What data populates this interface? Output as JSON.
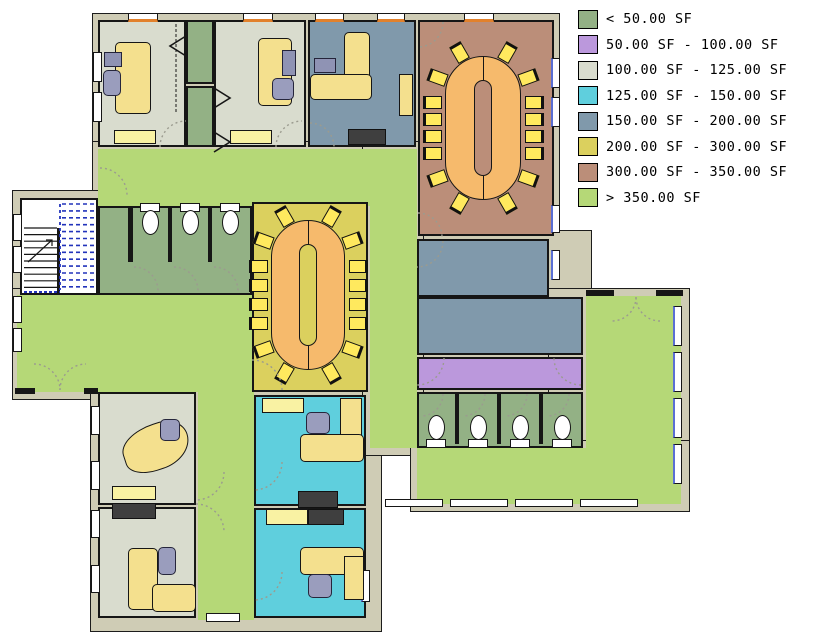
{
  "legend": {
    "items": [
      {
        "label": "< 50.00 SF",
        "color": "#93b185"
      },
      {
        "label": "50.00 SF - 100.00 SF",
        "color": "#bb98dc"
      },
      {
        "label": "100.00 SF - 125.00 SF",
        "color": "#d9dcce"
      },
      {
        "label": "125.00 SF - 150.00 SF",
        "color": "#5fcfdd"
      },
      {
        "label": "150.00 SF - 200.00 SF",
        "color": "#8099ab"
      },
      {
        "label": "200.00 SF - 300.00 SF",
        "color": "#dbd05e"
      },
      {
        "label": "300.00 SF - 350.00 SF",
        "color": "#bb8e79"
      },
      {
        "label": "> 350.00 SF",
        "color": "#b5d877"
      }
    ]
  },
  "plan": {
    "colors": {
      "wall": "#cfccb5",
      "outline": "#1c1c1c",
      "stair_room": "#ffffff",
      "table": "#f6ba6c",
      "chair_yellow": "#ffe95e",
      "door_arc": "#9b9b8f",
      "stair_path": "#2233bb",
      "accent_top": "#e2812c",
      "accent_side": "#5a6fd4"
    },
    "backdrops": [
      {
        "x": 92,
        "y": 13,
        "w": 468,
        "h": 231
      },
      {
        "x": 92,
        "y": 141,
        "w": 290,
        "h": 261
      },
      {
        "x": 12,
        "y": 190,
        "w": 110,
        "h": 210
      },
      {
        "x": 12,
        "y": 288,
        "w": 248,
        "h": 112
      },
      {
        "x": 90,
        "y": 384,
        "w": 292,
        "h": 248
      },
      {
        "x": 410,
        "y": 230,
        "w": 182,
        "h": 282
      },
      {
        "x": 548,
        "y": 288,
        "w": 142,
        "h": 224
      },
      {
        "x": 362,
        "y": 141,
        "w": 62,
        "h": 315
      },
      {
        "x": 410,
        "y": 440,
        "w": 280,
        "h": 72
      }
    ],
    "halls": [
      {
        "name": "corridor-north",
        "x": 98,
        "y": 149,
        "w": 318,
        "h": 57
      },
      {
        "name": "corridor-mid-vertical",
        "x": 370,
        "y": 149,
        "w": 47,
        "h": 299
      },
      {
        "name": "lobby-west",
        "x": 17,
        "y": 295,
        "w": 235,
        "h": 97
      },
      {
        "name": "corridor-south",
        "x": 198,
        "y": 392,
        "w": 56,
        "h": 228
      },
      {
        "name": "hall-southeast",
        "x": 417,
        "y": 448,
        "w": 264,
        "h": 56
      },
      {
        "name": "open-room-east",
        "x": 586,
        "y": 296,
        "w": 95,
        "h": 208
      }
    ],
    "rooms": [
      {
        "name": "office-nw-1",
        "cat": 2,
        "x": 98,
        "y": 20,
        "w": 88,
        "h": 127
      },
      {
        "name": "closet-nw-a",
        "cat": 0,
        "x": 186,
        "y": 20,
        "w": 28,
        "h": 64
      },
      {
        "name": "closet-nw-b",
        "cat": 0,
        "x": 186,
        "y": 86,
        "w": 28,
        "h": 61
      },
      {
        "name": "office-nw-2",
        "cat": 2,
        "x": 214,
        "y": 20,
        "w": 92,
        "h": 127
      },
      {
        "name": "office-nw-3",
        "cat": 4,
        "x": 308,
        "y": 20,
        "w": 108,
        "h": 127
      },
      {
        "name": "conference-room-north",
        "cat": 6,
        "x": 418,
        "y": 20,
        "w": 136,
        "h": 216
      },
      {
        "name": "restroom-west",
        "cat": 0,
        "x": 98,
        "y": 206,
        "w": 154,
        "h": 89
      },
      {
        "name": "conference-room-center",
        "cat": 5,
        "x": 252,
        "y": 202,
        "w": 116,
        "h": 190
      },
      {
        "name": "office-sw-1",
        "cat": 2,
        "x": 98,
        "y": 392,
        "w": 98,
        "h": 113
      },
      {
        "name": "office-sw-2",
        "cat": 2,
        "x": 98,
        "y": 507,
        "w": 98,
        "h": 111
      },
      {
        "name": "office-s-1",
        "cat": 3,
        "x": 254,
        "y": 395,
        "w": 112,
        "h": 111
      },
      {
        "name": "office-s-2",
        "cat": 3,
        "x": 254,
        "y": 508,
        "w": 112,
        "h": 110
      },
      {
        "name": "room-east-upper",
        "cat": 4,
        "x": 417,
        "y": 239,
        "w": 132,
        "h": 58
      },
      {
        "name": "room-east-lower",
        "cat": 4,
        "x": 417,
        "y": 297,
        "w": 166,
        "h": 58
      },
      {
        "name": "corridor-east",
        "cat": 1,
        "x": 417,
        "y": 357,
        "w": 166,
        "h": 33
      },
      {
        "name": "restroom-east",
        "cat": 0,
        "x": 417,
        "y": 392,
        "w": 166,
        "h": 56
      }
    ],
    "stairwell": {
      "x": 20,
      "y": 198,
      "w": 78,
      "h": 97
    },
    "wall_segments": [
      {
        "x": 586,
        "y": 290,
        "w": 28,
        "h": 6
      },
      {
        "x": 656,
        "y": 290,
        "w": 27,
        "h": 6
      },
      {
        "x": 15,
        "y": 388,
        "w": 20,
        "h": 6
      },
      {
        "x": 84,
        "y": 388,
        "w": 14,
        "h": 6
      },
      {
        "x": 128,
        "y": 206,
        "w": 5,
        "h": 56
      },
      {
        "x": 168,
        "y": 206,
        "w": 4,
        "h": 56
      },
      {
        "x": 208,
        "y": 206,
        "w": 4,
        "h": 56
      },
      {
        "x": 455,
        "y": 394,
        "w": 4,
        "h": 50
      },
      {
        "x": 497,
        "y": 394,
        "w": 4,
        "h": 50
      },
      {
        "x": 539,
        "y": 394,
        "w": 4,
        "h": 50
      }
    ],
    "windows": [
      {
        "x": 128,
        "y": 13,
        "w": 30,
        "h": 9,
        "a": "t"
      },
      {
        "x": 243,
        "y": 13,
        "w": 30,
        "h": 9,
        "a": "t"
      },
      {
        "x": 315,
        "y": 13,
        "w": 29,
        "h": 9,
        "a": "t"
      },
      {
        "x": 377,
        "y": 13,
        "w": 28,
        "h": 9,
        "a": "t"
      },
      {
        "x": 464,
        "y": 13,
        "w": 30,
        "h": 9,
        "a": "t"
      },
      {
        "x": 551,
        "y": 58,
        "w": 9,
        "h": 30,
        "a": "s"
      },
      {
        "x": 551,
        "y": 97,
        "w": 9,
        "h": 30,
        "a": "s"
      },
      {
        "x": 551,
        "y": 205,
        "w": 9,
        "h": 28,
        "a": "s"
      },
      {
        "x": 551,
        "y": 250,
        "w": 9,
        "h": 30,
        "a": "s"
      },
      {
        "x": 93,
        "y": 52,
        "w": 9,
        "h": 30,
        "a": "n"
      },
      {
        "x": 93,
        "y": 92,
        "w": 9,
        "h": 30,
        "a": "n"
      },
      {
        "x": 13,
        "y": 214,
        "w": 9,
        "h": 27,
        "a": "n"
      },
      {
        "x": 13,
        "y": 246,
        "w": 9,
        "h": 27,
        "a": "n"
      },
      {
        "x": 13,
        "y": 296,
        "w": 9,
        "h": 27,
        "a": "n"
      },
      {
        "x": 13,
        "y": 328,
        "w": 9,
        "h": 24,
        "a": "n"
      },
      {
        "x": 91,
        "y": 406,
        "w": 9,
        "h": 29,
        "a": "n"
      },
      {
        "x": 91,
        "y": 461,
        "w": 9,
        "h": 29,
        "a": "n"
      },
      {
        "x": 91,
        "y": 510,
        "w": 9,
        "h": 28,
        "a": "n"
      },
      {
        "x": 91,
        "y": 565,
        "w": 9,
        "h": 28,
        "a": "n"
      },
      {
        "x": 206,
        "y": 613,
        "w": 34,
        "h": 9,
        "a": "n"
      },
      {
        "x": 361,
        "y": 570,
        "w": 9,
        "h": 32,
        "a": "s"
      },
      {
        "x": 673,
        "y": 306,
        "w": 9,
        "h": 40,
        "a": "s"
      },
      {
        "x": 673,
        "y": 352,
        "w": 9,
        "h": 40,
        "a": "s"
      },
      {
        "x": 673,
        "y": 398,
        "w": 9,
        "h": 40,
        "a": "s"
      },
      {
        "x": 673,
        "y": 444,
        "w": 9,
        "h": 40,
        "a": "s"
      },
      {
        "x": 385,
        "y": 499,
        "w": 58,
        "h": 8,
        "a": "n"
      },
      {
        "x": 450,
        "y": 499,
        "w": 58,
        "h": 8,
        "a": "n"
      },
      {
        "x": 515,
        "y": 499,
        "w": 58,
        "h": 8,
        "a": "n"
      },
      {
        "x": 580,
        "y": 499,
        "w": 58,
        "h": 8,
        "a": "n"
      }
    ],
    "furniture": [
      {
        "t": "desk",
        "x": 115,
        "y": 42,
        "w": 36,
        "h": 72
      },
      {
        "t": "chair",
        "x": 103,
        "y": 70,
        "w": 18,
        "h": 26
      },
      {
        "t": "monitor",
        "x": 104,
        "y": 52,
        "w": 18,
        "h": 15
      },
      {
        "t": "cabinet",
        "x": 114,
        "y": 130,
        "w": 42,
        "h": 14
      },
      {
        "t": "desk",
        "x": 258,
        "y": 38,
        "w": 34,
        "h": 68
      },
      {
        "t": "monitor",
        "x": 282,
        "y": 50,
        "w": 14,
        "h": 26
      },
      {
        "t": "chair",
        "x": 272,
        "y": 78,
        "w": 22,
        "h": 22
      },
      {
        "t": "cabinet",
        "x": 230,
        "y": 130,
        "w": 42,
        "h": 14
      },
      {
        "t": "desk",
        "x": 344,
        "y": 32,
        "w": 26,
        "h": 54
      },
      {
        "t": "desk",
        "x": 310,
        "y": 74,
        "w": 62,
        "h": 26
      },
      {
        "t": "monitor",
        "x": 314,
        "y": 58,
        "w": 22,
        "h": 15
      },
      {
        "t": "panel",
        "x": 399,
        "y": 74,
        "w": 14,
        "h": 42
      },
      {
        "t": "credenza",
        "x": 348,
        "y": 129,
        "w": 38,
        "h": 16
      },
      {
        "t": "blob",
        "x": 122,
        "y": 424,
        "w": 68,
        "h": 46
      },
      {
        "t": "chair",
        "x": 160,
        "y": 419,
        "w": 20,
        "h": 22
      },
      {
        "t": "cabinet",
        "x": 112,
        "y": 486,
        "w": 44,
        "h": 14
      },
      {
        "t": "credenza",
        "x": 112,
        "y": 503,
        "w": 44,
        "h": 16
      },
      {
        "t": "desk",
        "x": 128,
        "y": 548,
        "w": 30,
        "h": 62
      },
      {
        "t": "desk",
        "x": 152,
        "y": 584,
        "w": 44,
        "h": 28
      },
      {
        "t": "chair",
        "x": 158,
        "y": 547,
        "w": 18,
        "h": 28
      },
      {
        "t": "cabinet",
        "x": 262,
        "y": 398,
        "w": 42,
        "h": 15
      },
      {
        "t": "panel",
        "x": 340,
        "y": 398,
        "w": 22,
        "h": 44
      },
      {
        "t": "desk",
        "x": 300,
        "y": 434,
        "w": 64,
        "h": 28
      },
      {
        "t": "chair",
        "x": 306,
        "y": 412,
        "w": 24,
        "h": 22
      },
      {
        "t": "credenza",
        "x": 298,
        "y": 491,
        "w": 40,
        "h": 17
      },
      {
        "t": "cabinet",
        "x": 266,
        "y": 509,
        "w": 42,
        "h": 16
      },
      {
        "t": "credenza",
        "x": 308,
        "y": 509,
        "w": 36,
        "h": 16
      },
      {
        "t": "desk",
        "x": 300,
        "y": 547,
        "w": 64,
        "h": 28
      },
      {
        "t": "chair",
        "x": 308,
        "y": 574,
        "w": 24,
        "h": 24
      },
      {
        "t": "panel",
        "x": 344,
        "y": 556,
        "w": 20,
        "h": 44
      }
    ],
    "tables": [
      {
        "name": "conference-table-north",
        "x": 445,
        "y": 56,
        "w": 76,
        "h": 144,
        "slotFill": "#bb8e79"
      },
      {
        "name": "conference-table-center",
        "x": 271,
        "y": 220,
        "w": 74,
        "h": 150,
        "slotFill": "#dbd05e"
      }
    ],
    "toilets": [
      {
        "cx": 150,
        "cy": 221,
        "d": 1
      },
      {
        "cx": 190,
        "cy": 221,
        "d": 1
      },
      {
        "cx": 230,
        "cy": 221,
        "d": 1
      },
      {
        "cx": 436,
        "cy": 431,
        "d": -1
      },
      {
        "cx": 478,
        "cy": 431,
        "d": -1
      },
      {
        "cx": 520,
        "cy": 431,
        "d": -1
      },
      {
        "cx": 562,
        "cy": 431,
        "d": -1
      }
    ],
    "door_arcs": [
      {
        "cx": 186,
        "cy": 147,
        "r": 26,
        "a0": 180,
        "a1": 270
      },
      {
        "cx": 302,
        "cy": 147,
        "r": 26,
        "a0": 180,
        "a1": 270
      },
      {
        "cx": 310,
        "cy": 147,
        "r": 24,
        "a0": 270,
        "a1": 360
      },
      {
        "cx": 418,
        "cy": 22,
        "r": 25,
        "a0": 0,
        "a1": 90
      },
      {
        "cx": 418,
        "cy": 237,
        "r": 24,
        "a0": 270,
        "a1": 360
      },
      {
        "cx": 417,
        "cy": 241,
        "r": 26,
        "a0": 0,
        "a1": 90
      },
      {
        "cx": 252,
        "cy": 390,
        "r": 30,
        "a0": 270,
        "a1": 360
      },
      {
        "cx": 100,
        "cy": 195,
        "r": 27,
        "a0": 270,
        "a1": 360
      },
      {
        "cx": 34,
        "cy": 390,
        "r": 26,
        "a0": 270,
        "a1": 360
      },
      {
        "cx": 86,
        "cy": 390,
        "r": 26,
        "a0": 180,
        "a1": 270
      },
      {
        "cx": 612,
        "cy": 297,
        "r": 24,
        "a0": 0,
        "a1": 90
      },
      {
        "cx": 660,
        "cy": 297,
        "r": 24,
        "a0": 90,
        "a1": 180
      },
      {
        "cx": 196,
        "cy": 472,
        "r": 28,
        "a0": 0,
        "a1": 90
      },
      {
        "cx": 196,
        "cy": 532,
        "r": 28,
        "a0": 270,
        "a1": 360
      },
      {
        "cx": 254,
        "cy": 462,
        "r": 28,
        "a0": 0,
        "a1": 90
      },
      {
        "cx": 254,
        "cy": 572,
        "r": 28,
        "a0": 0,
        "a1": 90
      },
      {
        "cx": 417,
        "cy": 358,
        "r": 27,
        "a0": 0,
        "a1": 90
      },
      {
        "cx": 581,
        "cy": 358,
        "r": 27,
        "a0": 90,
        "a1": 180
      },
      {
        "cx": 421,
        "cy": 394,
        "r": 22,
        "a0": 0,
        "a1": 90
      },
      {
        "cx": 463,
        "cy": 394,
        "r": 22,
        "a0": 0,
        "a1": 90
      },
      {
        "cx": 505,
        "cy": 394,
        "r": 22,
        "a0": 0,
        "a1": 90
      },
      {
        "cx": 547,
        "cy": 394,
        "r": 22,
        "a0": 0,
        "a1": 90
      },
      {
        "cx": 134,
        "cy": 291,
        "r": 24,
        "a0": 270,
        "a1": 360
      },
      {
        "cx": 174,
        "cy": 291,
        "r": 24,
        "a0": 270,
        "a1": 360
      },
      {
        "cx": 214,
        "cy": 291,
        "r": 24,
        "a0": 270,
        "a1": 360
      }
    ],
    "chevrons": [
      [
        186,
        36,
        170,
        46,
        186,
        56
      ],
      [
        214,
        88,
        230,
        98,
        214,
        108
      ],
      [
        214,
        132,
        230,
        142,
        214,
        152
      ]
    ],
    "dashed_lines": [
      [
        176,
        24,
        176,
        112
      ]
    ]
  }
}
